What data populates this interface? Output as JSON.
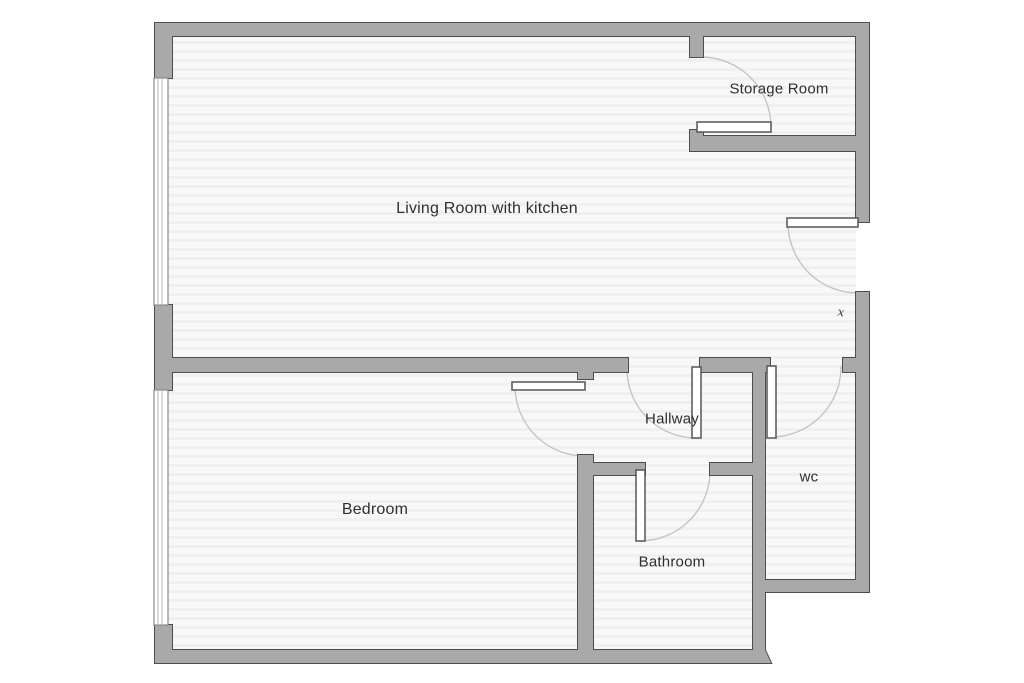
{
  "plan": {
    "background": "#ffffff",
    "floor_base": "#f8f8f8",
    "floor_stripe": "#f0f0f0",
    "wall_fill": "#a9a9a9",
    "wall_outline": "#4d4d4d",
    "window_fill": "#ffffff",
    "window_outline": "#8a8a8a",
    "window_mullion": "#b5b5b5",
    "door_fill": "#ffffff",
    "door_outline": "#555555",
    "arc_color": "#c5c5c5",
    "label_color": "#2f2f2f"
  },
  "rooms": [
    {
      "id": "living-room",
      "label": "Living Room with kitchen",
      "cx": 487,
      "cy": 209,
      "font_size": 16
    },
    {
      "id": "storage-room",
      "label": "Storage Room",
      "cx": 779,
      "cy": 89,
      "font_size": 15
    },
    {
      "id": "hallway",
      "label": "Hallway",
      "cx": 672,
      "cy": 419,
      "font_size": 15
    },
    {
      "id": "wc",
      "label": "wc",
      "cx": 809,
      "cy": 477,
      "font_size": 15
    },
    {
      "id": "bedroom",
      "label": "Bedroom",
      "cx": 375,
      "cy": 510,
      "font_size": 16
    },
    {
      "id": "bathroom",
      "label": "Bathroom",
      "cx": 672,
      "cy": 562,
      "font_size": 15
    }
  ],
  "symbols": [
    {
      "id": "switch-mark",
      "glyph": "x",
      "x": 841,
      "y": 312,
      "font_size": 12
    }
  ],
  "floor_areas": [
    {
      "id": "upper-floor",
      "x": 168,
      "y": 36,
      "w": 688,
      "h": 556
    },
    {
      "id": "lower-floor",
      "x": 168,
      "y": 592,
      "w": 585,
      "h": 58
    }
  ],
  "walls": [
    {
      "id": "outer-top",
      "x": 155,
      "y": 23,
      "w": 714,
      "h": 13
    },
    {
      "id": "outer-left-upper",
      "x": 155,
      "y": 36,
      "w": 17,
      "h": 42
    },
    {
      "id": "outer-left-middle",
      "x": 155,
      "y": 305,
      "w": 17,
      "h": 85
    },
    {
      "id": "outer-left-lower",
      "x": 155,
      "y": 625,
      "w": 17,
      "h": 37
    },
    {
      "id": "outer-bottom",
      "x": 155,
      "y": 650,
      "w": 610,
      "h": 13
    },
    {
      "id": "outer-right-upper",
      "x": 856,
      "y": 36,
      "w": 13,
      "h": 186
    },
    {
      "id": "outer-right-lower",
      "x": 856,
      "y": 292,
      "w": 13,
      "h": 288
    },
    {
      "id": "wc-bottom",
      "x": 753,
      "y": 580,
      "w": 116,
      "h": 12
    },
    {
      "id": "storage-stub-top",
      "x": 690,
      "y": 36,
      "w": 13,
      "h": 21
    },
    {
      "id": "storage-stub-bottom",
      "x": 690,
      "y": 130,
      "w": 13,
      "h": 10
    },
    {
      "id": "storage-bottom",
      "x": 690,
      "y": 136,
      "w": 179,
      "h": 15
    },
    {
      "id": "main-divider",
      "x": 155,
      "y": 358,
      "w": 473,
      "h": 14
    },
    {
      "id": "hallway-top",
      "x": 700,
      "y": 358,
      "w": 70,
      "h": 14
    },
    {
      "id": "wc-top-stub",
      "x": 843,
      "y": 358,
      "w": 13,
      "h": 14
    },
    {
      "id": "bedroom-hall-stub",
      "x": 578,
      "y": 372,
      "w": 15,
      "h": 7
    },
    {
      "id": "bedroom-bath-wall",
      "x": 578,
      "y": 455,
      "w": 15,
      "h": 195
    },
    {
      "id": "hall-wc-wall",
      "x": 753,
      "y": 372,
      "w": 12,
      "h": 278
    },
    {
      "id": "bathroom-top-left",
      "x": 580,
      "y": 463,
      "w": 65,
      "h": 12
    },
    {
      "id": "bathroom-top-right",
      "x": 710,
      "y": 463,
      "w": 55,
      "h": 12
    }
  ],
  "notch": {
    "id": "wall-end-notch",
    "points": "765,650 771,663 757,663"
  },
  "windows": [
    {
      "id": "living-room-window",
      "x": 154,
      "y": 78,
      "w": 14,
      "h": 227
    },
    {
      "id": "bedroom-window",
      "x": 154,
      "y": 390,
      "w": 14,
      "h": 235
    }
  ],
  "doors": [
    {
      "id": "storage-door",
      "leaf": {
        "x": 697,
        "y": 122,
        "w": 74,
        "h": 10
      },
      "arc": "M 701 57 A 70 70 0 0 1 771 127"
    },
    {
      "id": "entry-door",
      "leaf": {
        "x": 787,
        "y": 218,
        "w": 71,
        "h": 9
      },
      "arc": "M 788 223 A 70 70 0 0 0 858 293"
    },
    {
      "id": "hallway-door",
      "leaf": {
        "x": 692,
        "y": 367,
        "w": 9,
        "h": 71
      },
      "arc": "M 627 369 A 69 69 0 0 0 696 438"
    },
    {
      "id": "bedroom-door",
      "leaf": {
        "x": 512,
        "y": 382,
        "w": 73,
        "h": 8
      },
      "arc": "M 515 388 A 70 70 0 0 0 585 456"
    },
    {
      "id": "bathroom-door",
      "leaf": {
        "x": 636,
        "y": 470,
        "w": 9,
        "h": 71
      },
      "arc": "M 640 541 A 70 70 0 0 0 710 471"
    },
    {
      "id": "wc-door",
      "leaf": {
        "x": 767,
        "y": 366,
        "w": 9,
        "h": 72
      },
      "arc": "M 771 437 A 70 70 0 0 0 841 366"
    }
  ]
}
